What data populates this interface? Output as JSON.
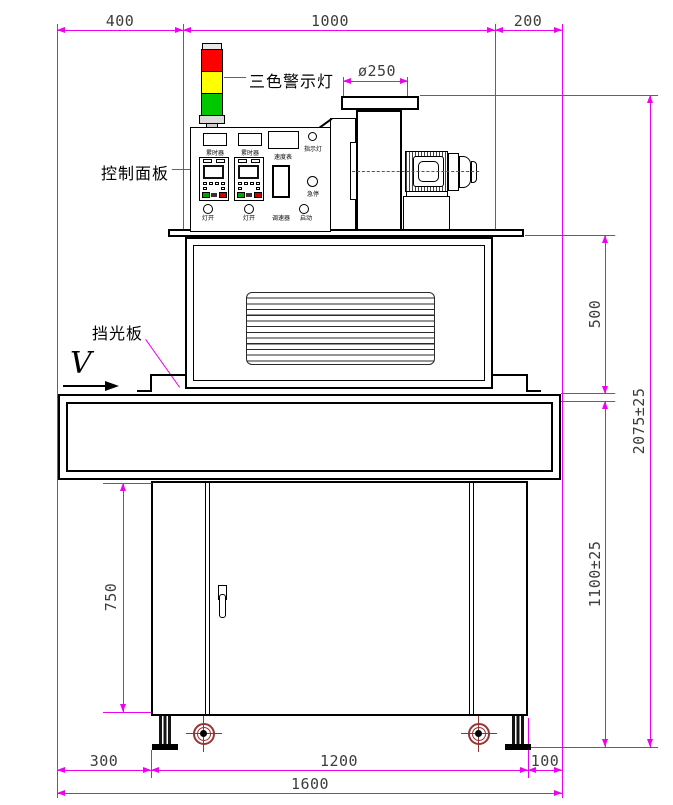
{
  "callouts": {
    "warning_light": "三色警示灯",
    "control_panel": "控制面板",
    "light_shield": "挡光板",
    "belt_direction": "V"
  },
  "panel": {
    "hour_meter_1": "累时器",
    "hour_meter_2": "累时器",
    "speed_meter": "速度表",
    "indicator_lamp": "指示灯",
    "emergency_stop": "急停",
    "lamp_switch_1": "灯开",
    "lamp_switch_2": "灯开",
    "speed_regulator": "调速器",
    "start_button": "启动"
  },
  "dimensions": {
    "top_left": "400",
    "top_center": "1000",
    "top_right": "200",
    "blower_flange_diameter": "ø250",
    "oven_section_height": "500",
    "overall_height": "2075±25",
    "work_surface_height": "1100±25",
    "cabinet_height": "750",
    "bottom_left": "300",
    "bottom_center": "1200",
    "bottom_right": "100",
    "overall_width": "1600"
  },
  "colors": {
    "dimension_line": "#f000f0",
    "lamp_red": "#ff0000",
    "lamp_yellow": "#ffff00",
    "lamp_green": "#00c800",
    "centerline_red": "#cc2222",
    "caster_red": "#993333"
  }
}
